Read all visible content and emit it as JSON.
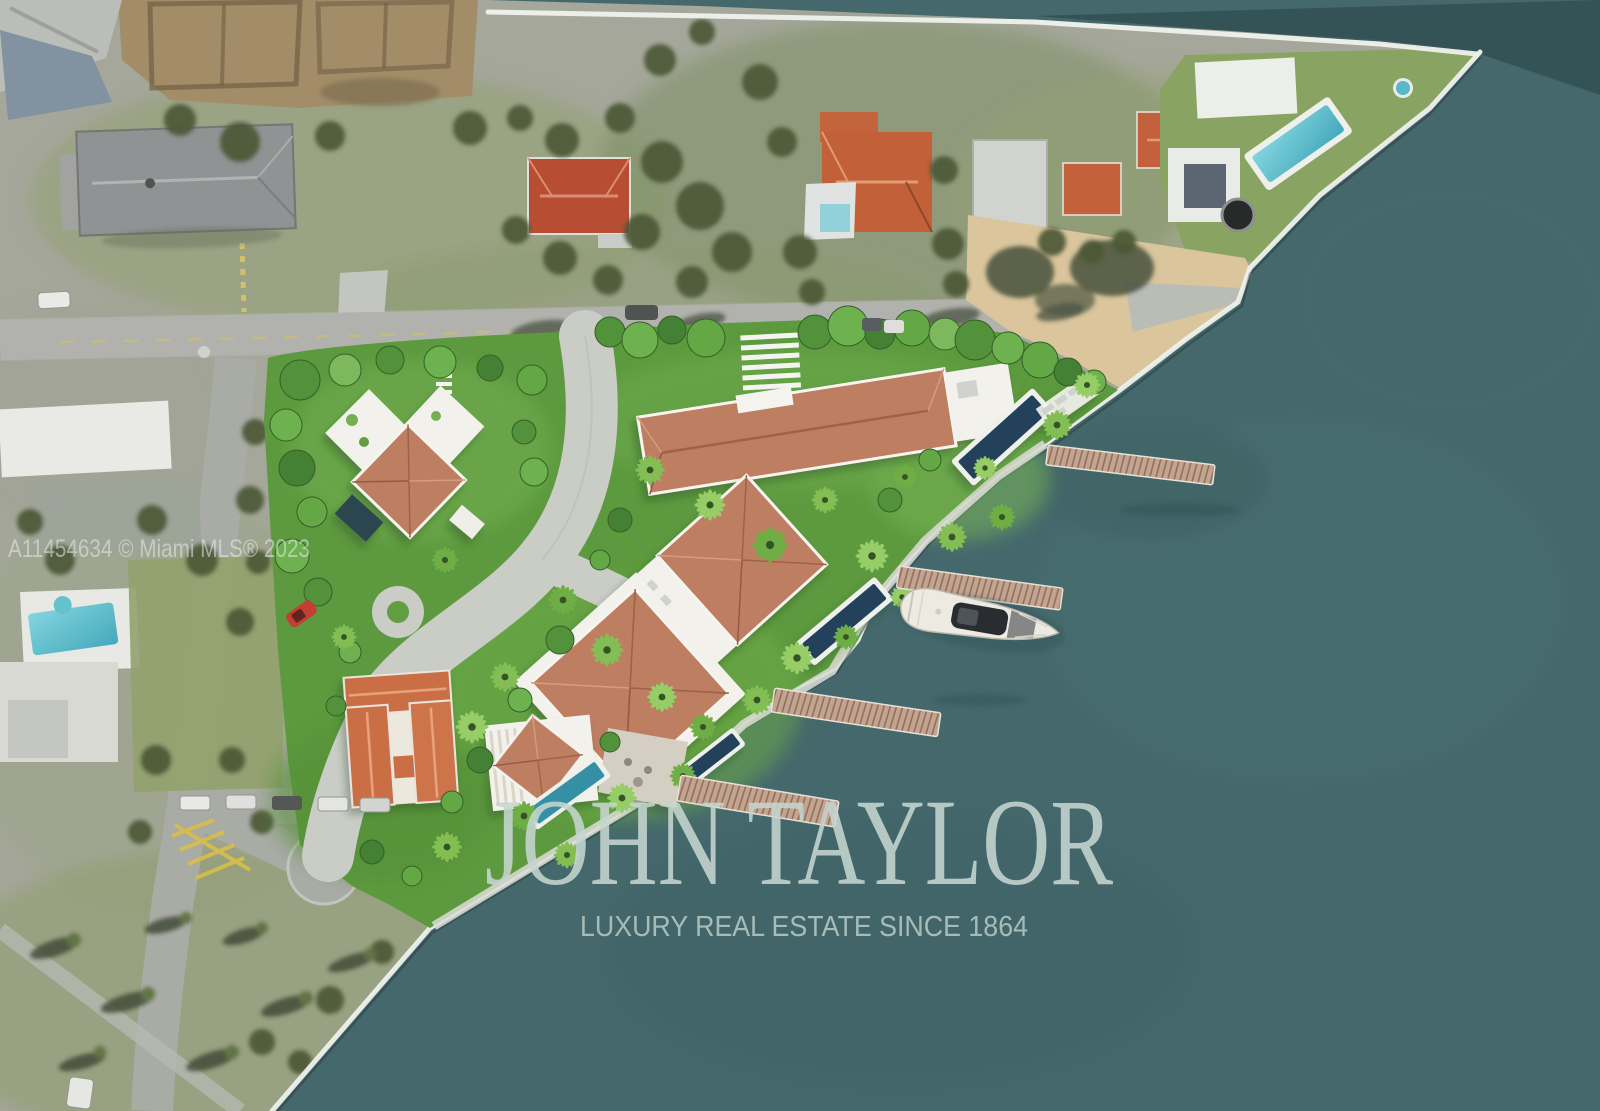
{
  "watermarks": {
    "mls": "A11454634 © Miami MLS® 2023",
    "brand": "JOHN TAYLOR",
    "tagline": "LUXURY REAL ESTATE SINCE 1864"
  },
  "palette": {
    "bay_water": "#3f6468",
    "channel_water": "#2c4a4e",
    "seawall_white": "#eff1ec",
    "satellite_land": "#a3a598",
    "satellite_grass": "#8a9a66",
    "render_grass": "#5d9a3c",
    "terracotta_roof": "#bc7a5c",
    "orange_tile_roof": "#c25f36",
    "white_roof": "#f2f1ec",
    "pool_navy": "#1d3a57",
    "pool_teal": "#57c4cf",
    "dock_wood": "#c2a28d",
    "road_gray": "#a7a9a3",
    "paver_gray": "#c9cbc5",
    "boat_hull": "#edeae2",
    "red_car": "#c0392b",
    "watermark_text": "#c6d6d0"
  }
}
